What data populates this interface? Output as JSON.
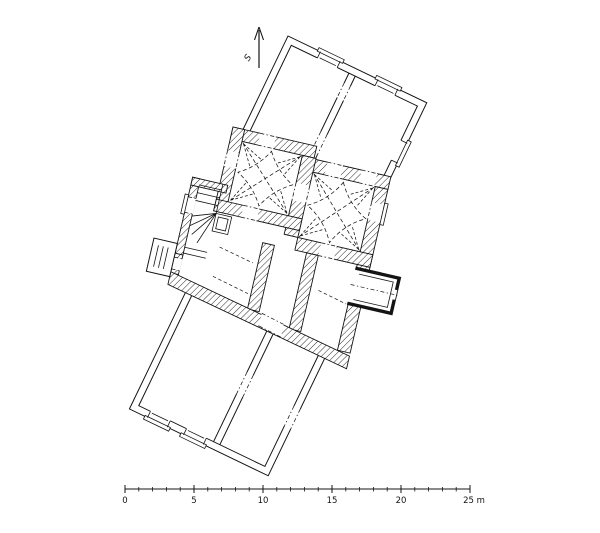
{
  "palette": {
    "ink": "#141414",
    "paper": "#ffffff"
  },
  "north_arrow": {
    "label": "S",
    "icon": "north-arrow-icon"
  },
  "scale_bar": {
    "unit": "m",
    "meters_per_major_tick": 5,
    "tick_labels": [
      {
        "label": "0"
      },
      {
        "label": "5"
      },
      {
        "label": "10"
      },
      {
        "label": "15"
      },
      {
        "label": "20"
      },
      {
        "label": "25 m"
      }
    ]
  },
  "drawing": {
    "kind": "architectural floor plan, scanned ink drawing",
    "features": [
      "north wing with two rooms",
      "medieval core with hatched walls",
      "two cloister-vaulted halls shown with dashed vault lines",
      "winder staircase with newel",
      "west porch",
      "east bay with thick black walls",
      "south wing with two rooms"
    ]
  }
}
